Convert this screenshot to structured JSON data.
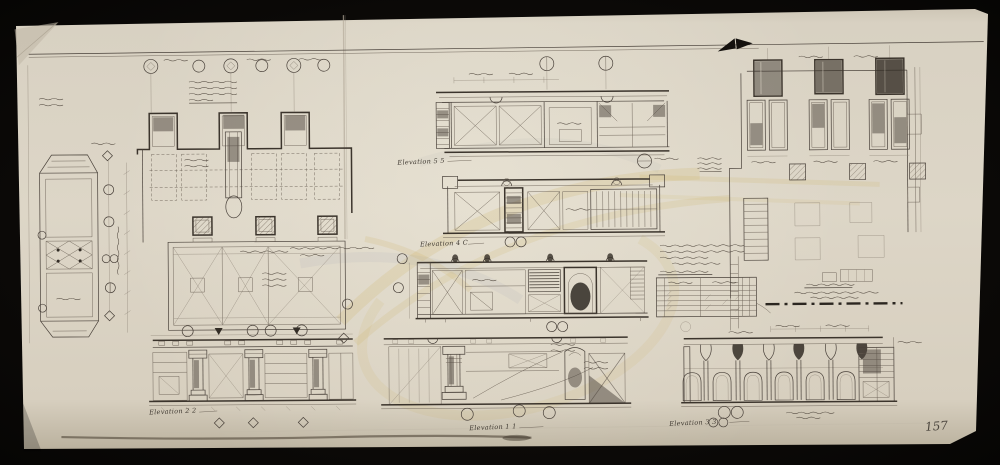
{
  "scene": {
    "background_color": "#0b0907",
    "paper_color": "#d9d2c3",
    "ink_color": "#49413a",
    "watermark_gold": "#c9a23a",
    "watermark_gray": "#98a0ac"
  },
  "sheet": {
    "number": "157",
    "media": "pencil architectural drawing on cream paper"
  },
  "captions": {
    "top_center": "Elevation 5 5",
    "mid_center": "Elevation 4 C",
    "bottom_left": "Elevation 2 2",
    "bottom_center": "Elevation 1 1",
    "bottom_right": "Elevation 3 3"
  }
}
